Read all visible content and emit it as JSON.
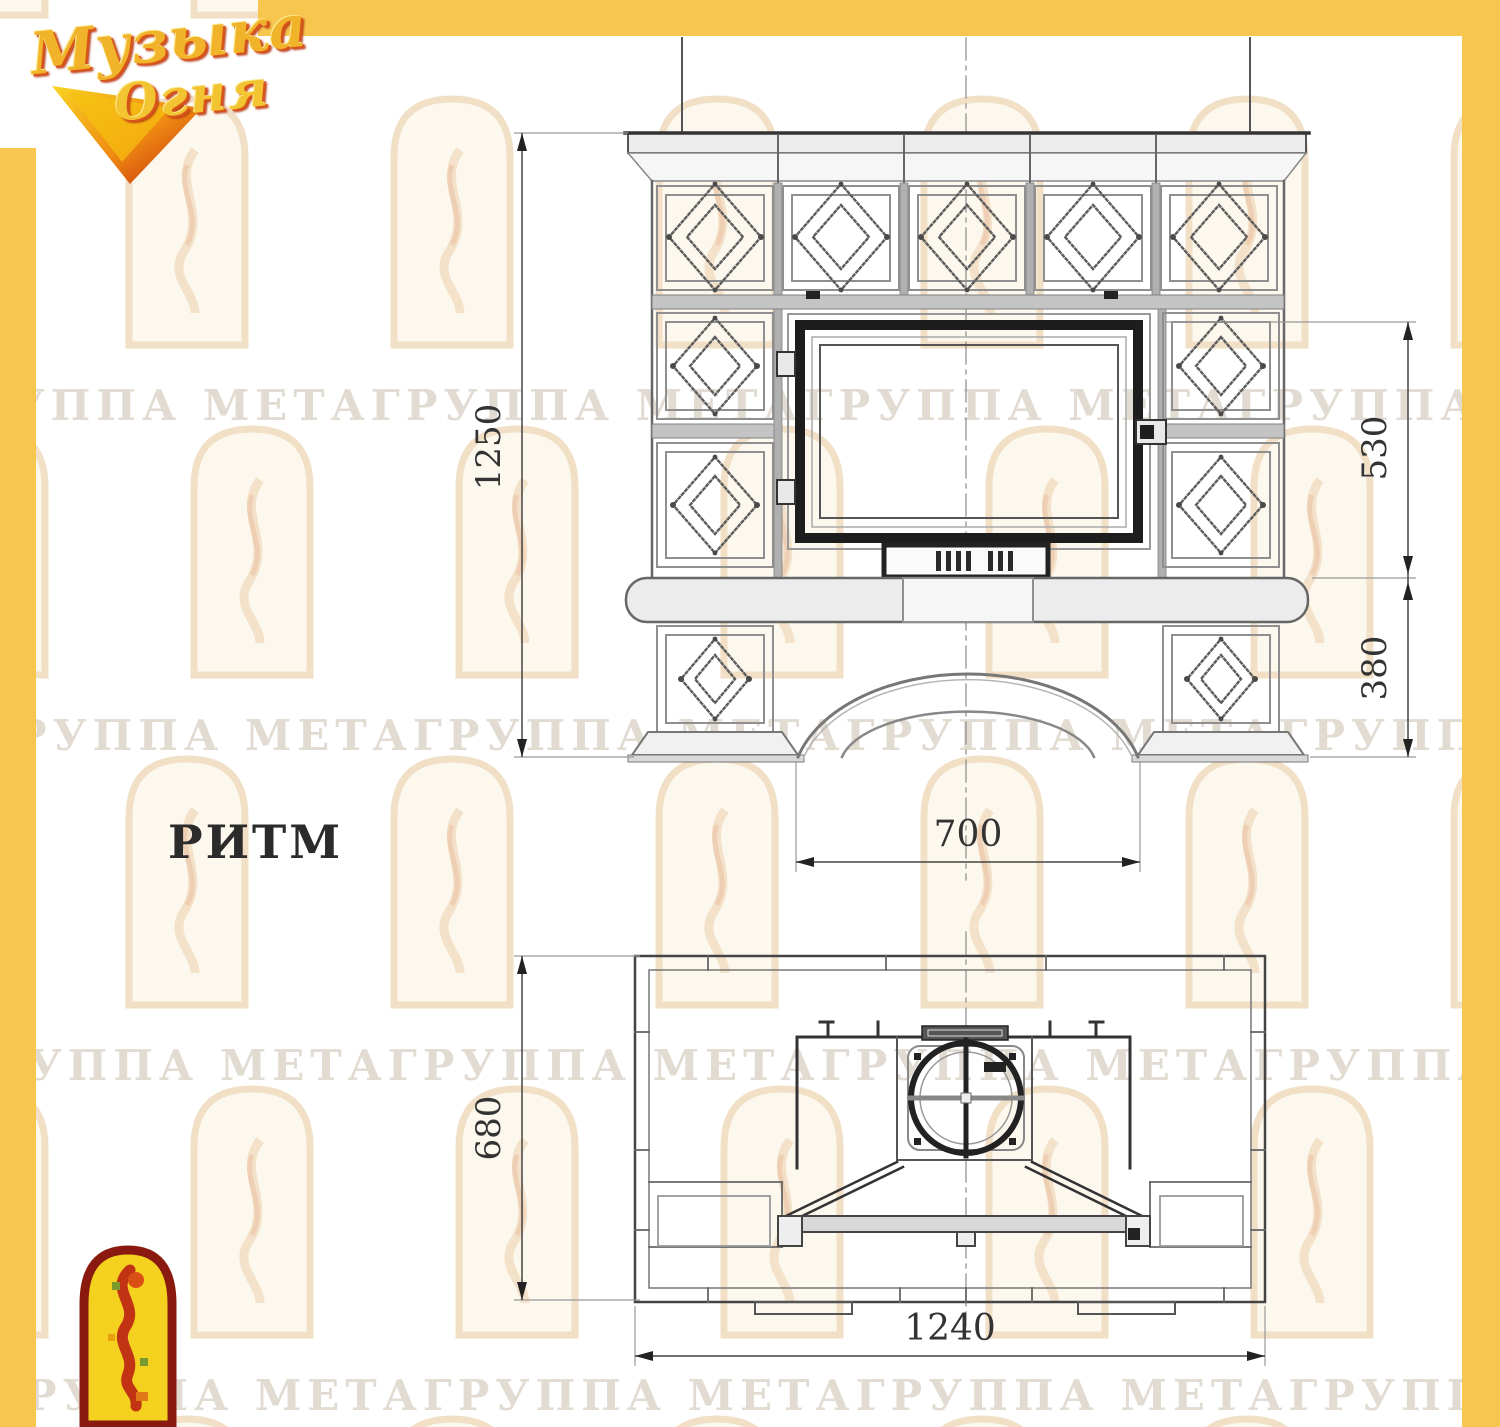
{
  "logo": {
    "word1": "Музыка",
    "word2": "Огня"
  },
  "model": {
    "title": "РИТМ"
  },
  "watermark": {
    "row_text": "ГРУППА МЕТАГРУППА МЕТАГРУППА МЕТАГРУППА МЕТАГРУППА МЕТАГРУППА МЕТА"
  },
  "front_view": {
    "label_total_height": "1250",
    "label_firebox_height": "530",
    "label_base_height": "380",
    "label_opening_width": "700"
  },
  "plan_view": {
    "label_depth": "680",
    "label_total_width": "1240"
  },
  "colors": {
    "border_yellow": "#f6c64e",
    "line_dark": "#333333",
    "line_gray": "#8a8a8a",
    "emblem_red": "#8a1a10",
    "emblem_yellow": "#f4d11e"
  }
}
